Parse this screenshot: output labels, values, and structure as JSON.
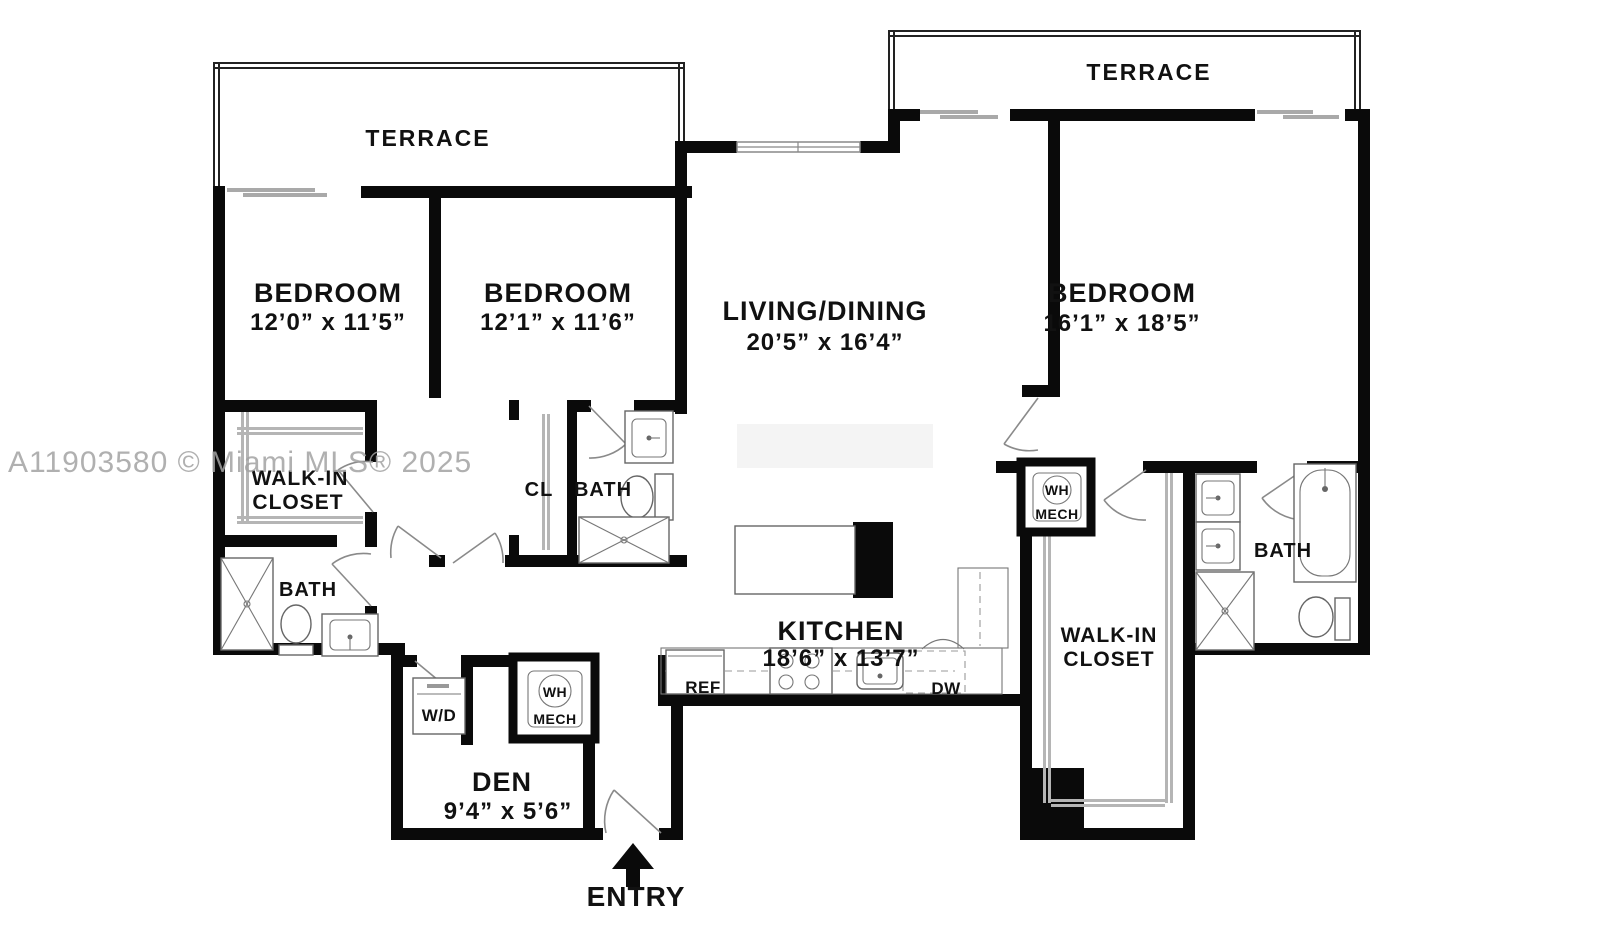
{
  "watermark": "A11903580 © Miami MLS® 2025",
  "rooms": {
    "terrace_left": "TERRACE",
    "terrace_right": "TERRACE",
    "bedroom_left": {
      "name": "BEDROOM",
      "dims": "12’0” x 11’5”"
    },
    "bedroom_mid": {
      "name": "BEDROOM",
      "dims": "12’1” x 11’6”"
    },
    "living": {
      "name": "LIVING/DINING",
      "dims": "20’5” x 16’4”"
    },
    "bedroom_right": {
      "name": "BEDROOM",
      "dims": "16’1” x 18’5”"
    },
    "kitchen": {
      "name": "KITCHEN",
      "dims": "18’6” x 13’7”"
    },
    "den": {
      "name": "DEN",
      "dims": "9’4” x 5’6”"
    },
    "walkin_left": {
      "line1": "WALK-IN",
      "line2": "CLOSET"
    },
    "walkin_right": {
      "line1": "WALK-IN",
      "line2": "CLOSET"
    },
    "bath_left": "BATH",
    "bath_mid": "BATH",
    "bath_right": "BATH",
    "closet_small": "CL",
    "entry": "ENTRY"
  },
  "fixtures": {
    "washer_dryer": "W/D",
    "water_heater_left": {
      "top": "WH",
      "bottom": "MECH"
    },
    "water_heater_right": {
      "top": "WH",
      "bottom": "MECH"
    },
    "refrigerator": "REF",
    "dishwasher": "DW"
  },
  "colors": {
    "wall": "#0a0a0a",
    "watermark": "#a3a3a3",
    "fixture_line": "#666666"
  }
}
